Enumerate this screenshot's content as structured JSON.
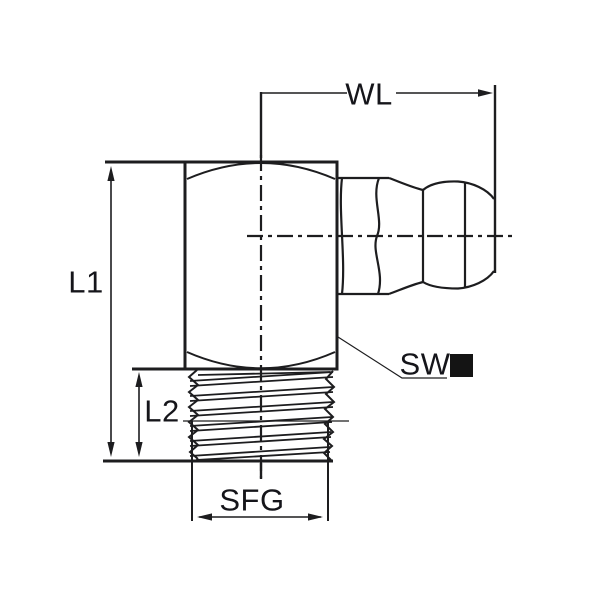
{
  "labels": {
    "wl": "WL",
    "l1": "L1",
    "l2": "L2",
    "sw": "SW",
    "sfg": "SFG"
  },
  "colors": {
    "line": "#1d1d1f",
    "text": "#15151a",
    "marker_square": "#141414",
    "background": "#ffffff"
  }
}
